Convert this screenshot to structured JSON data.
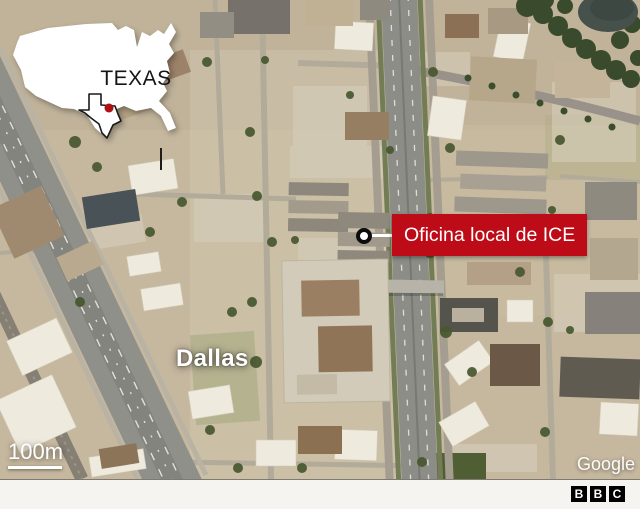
{
  "inset_map": {
    "region_label": "TEXAS",
    "country_shape": "usa-silhouette",
    "highlight_state": "Texas",
    "shape_fill": "#ffffff",
    "state_outline_color": "#1b1b1b",
    "marker_dot_color": "#ad1114"
  },
  "map": {
    "city_label": "Dallas",
    "callout": {
      "label": "Oficina local de ICE",
      "background_color": "#bd0b18",
      "text_color": "#ffffff"
    },
    "scale_bar": {
      "label": "100m"
    },
    "attribution": "Google"
  },
  "footer": {
    "logo": {
      "letters": [
        "B",
        "B",
        "C"
      ],
      "box_color": "#000000",
      "letter_color": "#ffffff"
    }
  }
}
